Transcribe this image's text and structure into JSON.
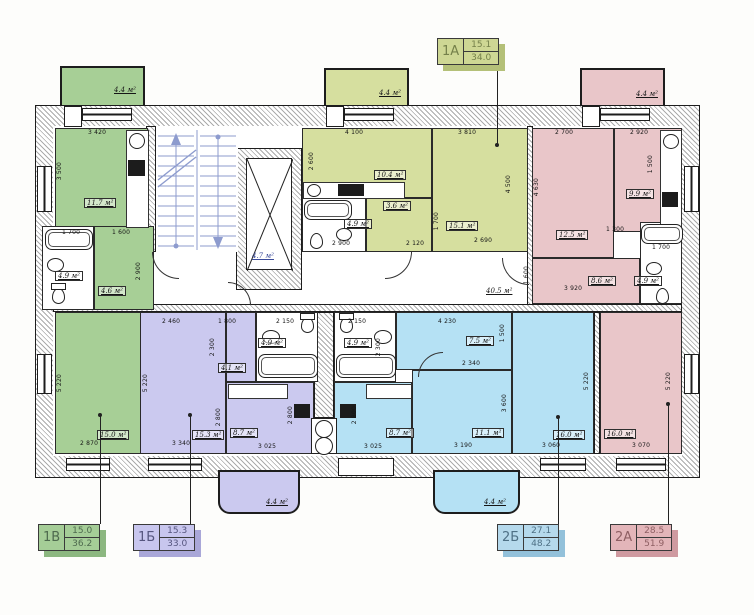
{
  "title": "Поэтажный план многоквартирного дома",
  "colors": {
    "apartment_1a": "#d6df9f",
    "apartment_1v": "#a7cf96",
    "apartment_1b": "#cbc9ef",
    "apartment_2b": "#b5e1f4",
    "apartment_2a": "#e9c6c9",
    "stairs": "#8d9bce",
    "walls": "#ababab"
  },
  "tags": {
    "t1a": {
      "id": "1А",
      "top": "15.1",
      "bottom": "34.0"
    },
    "t1v": {
      "id": "1В",
      "top": "15.0",
      "bottom": "36.2"
    },
    "t1b": {
      "id": "1Б",
      "top": "15.3",
      "bottom": "33.0"
    },
    "t2b": {
      "id": "2Б",
      "top": "27.1",
      "bottom": "48.2"
    },
    "t2a": {
      "id": "2А",
      "top": "28.5",
      "bottom": "51.9"
    }
  },
  "areas": {
    "kitchen_1v": "11.7 м²",
    "bath_1v": "4.9 м²",
    "hall_1v": "4.6 м²",
    "living_1v": "15.0 м²",
    "elevator": "4.7 м²",
    "corridor": "40.5 м²",
    "kitchen_1a": "10.4 м²",
    "hall_1a": "3.6 м²",
    "bath_1a": "4.9 м²",
    "living_1a": "15.1 м²",
    "room1_2a": "12.5 м²",
    "kitchen_2a": "9.9 м²",
    "room2_2a": "8.6 м²",
    "bath_2a": "4.9 м²",
    "living_2a": "16.0 м²",
    "living_1b": "15.3 м²",
    "hall_1b": "4.1 м²",
    "bath_1b": "4.9 м²",
    "kitchen_1b": "8.7 м²",
    "bath_2b": "4.9 м²",
    "kitchen_2b": "8.7 м²",
    "hall_2b": "7.5 м²",
    "room_2b": "11.1 м²",
    "living_2b": "16.0 м²",
    "balcony": "4.4 м²"
  },
  "dims": [
    "3 420",
    "3 500",
    "1 700",
    "1 600",
    "2 900",
    "4 100",
    "3 810",
    "2 600",
    "4 500",
    "2 900",
    "2 120",
    "2 690",
    "1 700",
    "2 700",
    "2 920",
    "4 630",
    "1 500",
    "1 300",
    "1 700",
    "3 920",
    "1 600",
    "2 460",
    "1 800",
    "2 150",
    "2 150",
    "4 230",
    "2 340",
    "1 500",
    "2 300",
    "2 300",
    "5 220",
    "5 220",
    "2 800",
    "2 800",
    "2 800",
    "3 600",
    "5 220",
    "5 220",
    "2 870",
    "3 340",
    "3 025",
    "3 025",
    "3 190",
    "3 060",
    "3 070"
  ]
}
